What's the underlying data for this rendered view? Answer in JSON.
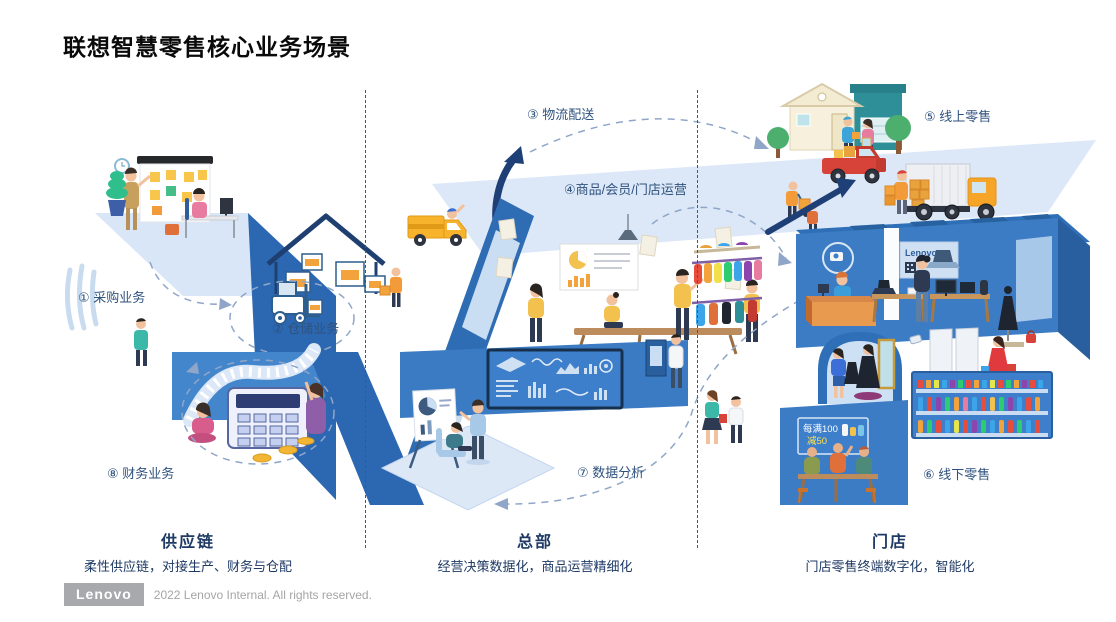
{
  "title": "联想智慧零售核心业务场景",
  "labels": {
    "s1": "① 采购业务",
    "s2": "② 仓储业务",
    "s3": "③ 物流配送",
    "s4": "④商品/会员/门店运营",
    "s5": "⑤ 线上零售",
    "s6": "⑥ 线下零售",
    "s7": "⑦ 数据分析",
    "s8": "⑧ 财务业务"
  },
  "sections": {
    "supply_chain": {
      "name": "供应链",
      "desc": "柔性供应链，对接生产、财务与仓配"
    },
    "headquarters": {
      "name": "总部",
      "desc": "经营决策数据化，商品运营精细化"
    },
    "store": {
      "name": "门店",
      "desc": "门店零售终端数字化，智能化"
    }
  },
  "scene_text": {
    "store_sign": "Lenovo",
    "promo_line1": "每满100",
    "promo_line2": "减50"
  },
  "footer": {
    "logo": "Lenovo",
    "copyright": "2022 Lenovo Internal. All rights reserved."
  },
  "colors": {
    "platform_light": "#d9e6f7",
    "platform_dark": "#2c68b2",
    "wall_blue": "#3c7cc4",
    "screen_blue": "#3e7fcb",
    "screen_border": "#17304e",
    "dash_line": "#8fa6c8",
    "label_navy": "#2f527e",
    "section_navy": "#1f3a64",
    "accent_orange": "#f2a33c",
    "accent_yellow": "#f2c14e",
    "accent_red": "#d84339",
    "logo_gray": "#a7a9ac"
  }
}
